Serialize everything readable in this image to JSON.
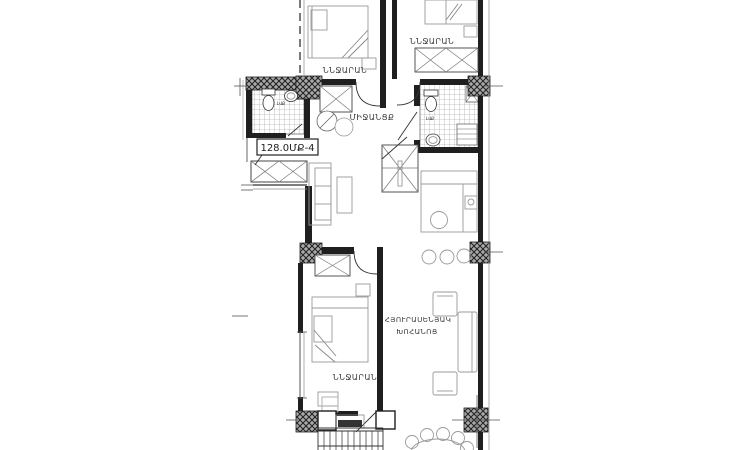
{
  "plan": {
    "area_label": "128.0ՄՔ-4",
    "rooms": {
      "bedroom_top_left": "ՆՆՋԱՐԱՆ",
      "bedroom_top_right": "ՆՆՋԱՐԱՆ",
      "bedroom_bottom": "ՆՆՋԱՐԱՆ",
      "corridor": "ՄԻՋԱՆՑՔ",
      "living_line1": "ՀՅՈՒՐԱՍԵՆՅԱԿ",
      "living_line2": "ԽՈՀԱՆՈՑ",
      "bathroom_left": "ԼՎՔ",
      "bathroom_right": "ԼՎՔ"
    },
    "colors": {
      "wall": "#1f1f1f",
      "furniture_outline": "#999999",
      "tile_line": "#8f8f8f",
      "label_text": "#3a3a3a",
      "background": "#ffffff"
    }
  }
}
